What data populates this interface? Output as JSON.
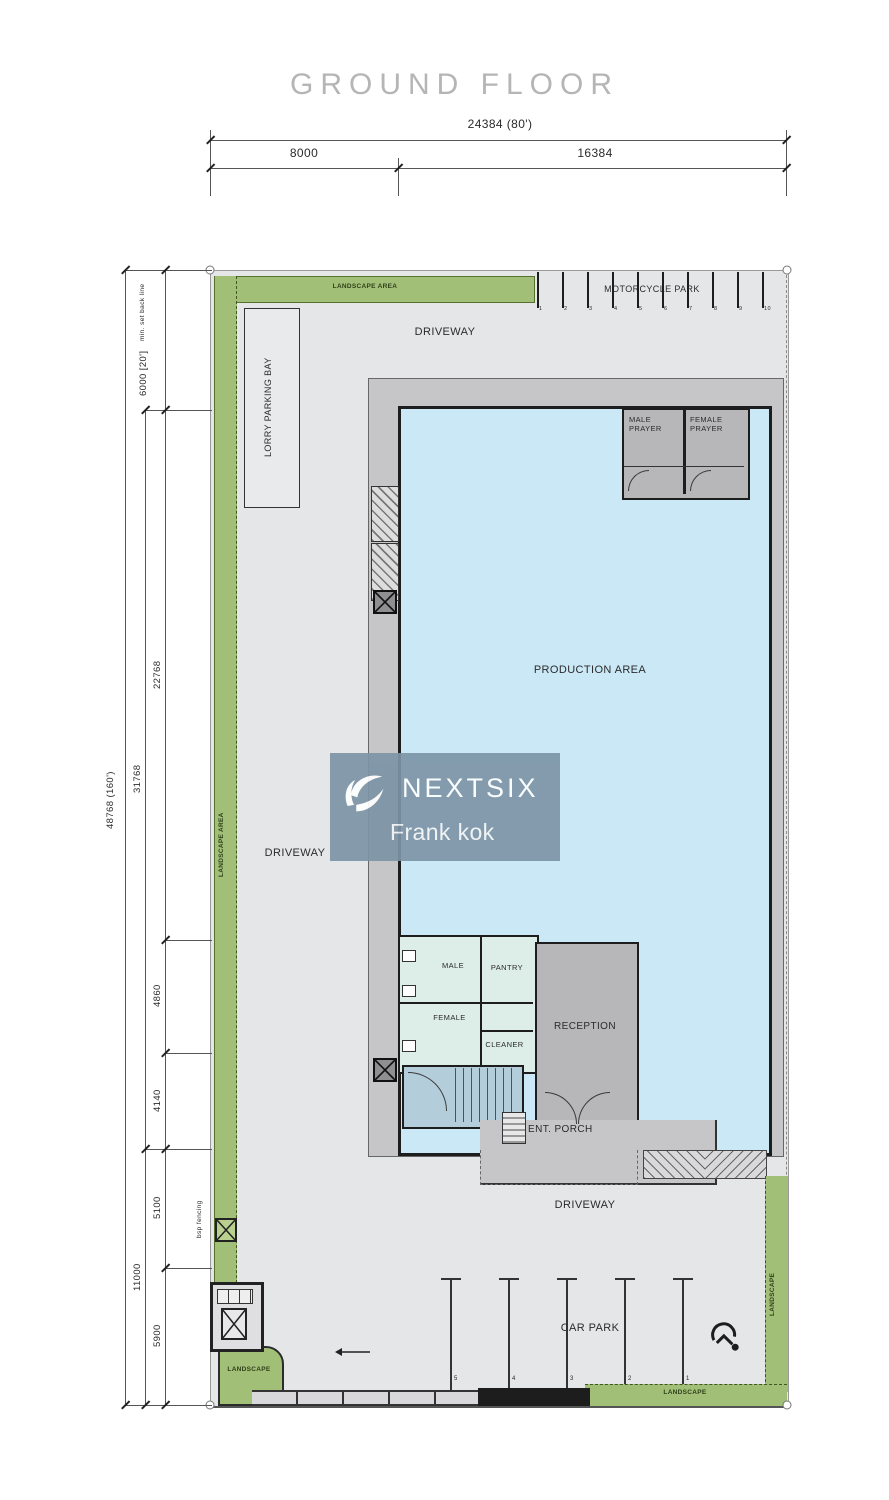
{
  "title": "GROUND FLOOR",
  "watermark": {
    "brand": "NEXTSIX",
    "agent": "Frank kok"
  },
  "dims": {
    "top_overall": "24384 (80')",
    "top_seg_left": "8000",
    "top_seg_right": "16384",
    "left_overall": "48768 (160')",
    "left_mid_upper": "31768",
    "left_mid_lower": "11000",
    "seg_setback": "6000 [20']",
    "setback_note": "min. set back line",
    "seg_22768": "22768",
    "seg_4860": "4860",
    "seg_4140": "4140",
    "seg_5100": "5100",
    "seg_5900": "5900"
  },
  "labels": {
    "landscape_top": "LANDSCAPE AREA",
    "motorcycle_park": "MOTORCYCLE PARK",
    "driveway_top": "DRIVEWAY",
    "lorry_parking_bay": "LORRY PARKING BAY",
    "landscape_left": "LANDSCAPE AREA",
    "male_prayer": "MALE PRAYER",
    "female_prayer": "FEMALE PRAYER",
    "production_area": "PRODUCTION AREA",
    "driveway_mid": "DRIVEWAY",
    "male": "MALE",
    "pantry": "PANTRY",
    "female": "FEMALE",
    "cleaner": "CLEANER",
    "reception": "RECEPTION",
    "ent_porch": "ENT. PORCH",
    "driveway_bottom": "DRIVEWAY",
    "car_park": "CAR PARK",
    "landscape_right": "LANDSCAPE",
    "landscape_bottom": "LANDSCAPE",
    "landscape_corner": "LANDSCAPE",
    "bsp_fencing": "bsp fencing"
  },
  "motorcycle_bays": [
    "1",
    "2",
    "3",
    "4",
    "5",
    "6",
    "7",
    "8",
    "9",
    "10"
  ],
  "car_bays": [
    "5",
    "4",
    "3",
    "2",
    "1"
  ],
  "colors": {
    "landscape_green": "#a2bf78",
    "landscape_text": "#2f4018",
    "driveway_gray": "#e5e6e8",
    "building_band": "#c6c6c8",
    "production_blue": "#cbe8f6",
    "room_gray": "#b7b7ba",
    "toilet_green": "#dceee7",
    "stair_blue": "#b4cdda",
    "wall_dark": "#1d1d1d",
    "dim_line": "#555555",
    "title_gray": "#b5b5b5",
    "watermark_bg": "#7d95a6"
  }
}
